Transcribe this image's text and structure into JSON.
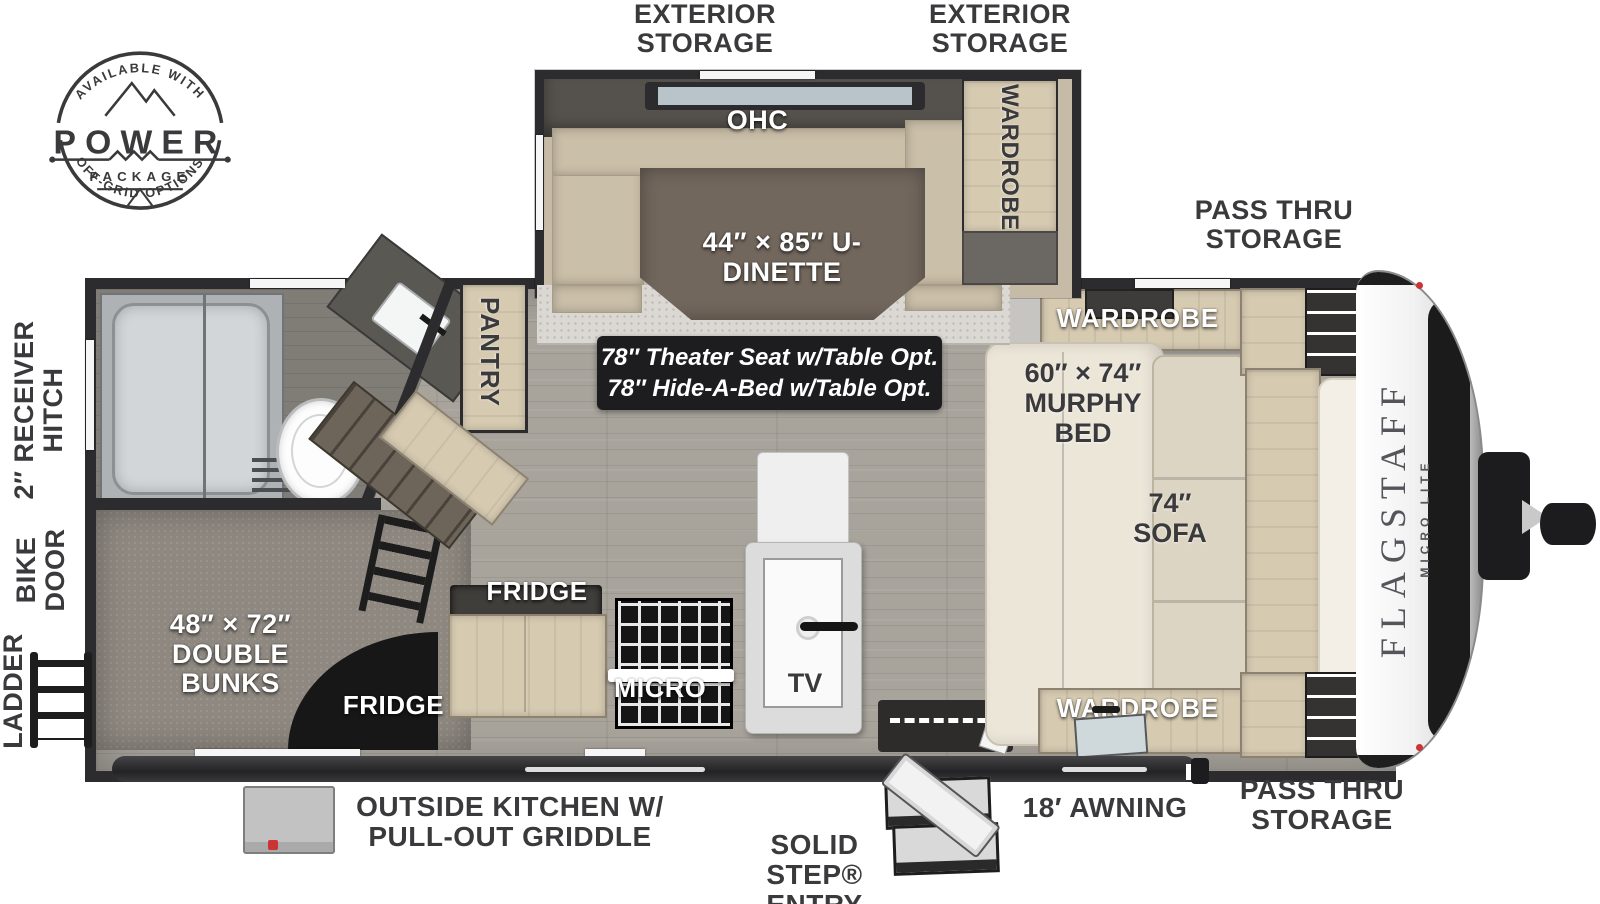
{
  "badge": {
    "arc_top": "AVAILABLE WITH",
    "word": "POWER",
    "word_sub": "PACKAGE",
    "arc_bottom": "OFF-GRID OPTIONS"
  },
  "top_labels": {
    "exterior_storage_left": "EXTERIOR STORAGE",
    "exterior_storage_right": "EXTERIOR STORAGE",
    "pass_thru_storage": "PASS THRU STORAGE"
  },
  "left_labels": {
    "receiver_hitch": "2″ RECEIVER HITCH",
    "bike_door": "BIKE DOOR",
    "ladder": "LADDER"
  },
  "bottom_labels": {
    "outside_kitchen": "OUTSIDE KITCHEN W/ PULL-OUT GRIDDLE",
    "solid_step": "SOLID STEP® ENTRY",
    "awning": "18′ AWNING",
    "pass_thru_storage": "PASS THRU STORAGE"
  },
  "slide": {
    "ohc": "OHC",
    "dinette": "44″ × 85″ U-DINETTE",
    "wardrobe": "WARDROBE"
  },
  "options_box": {
    "line1": "78″ Theater Seat w/Table Opt.",
    "line2": "78″ Hide-A-Bed w/Table Opt."
  },
  "rooms": {
    "pantry": "PANTRY",
    "double_bunks": "48″ × 72″ DOUBLE BUNKS",
    "fridge_top": "FRIDGE",
    "fridge_bottom": "FRIDGE",
    "micro": "MICRO",
    "tv": "TV",
    "murphy_bed": "60″ × 74″ MURPHY BED",
    "sofa": "74″ SOFA",
    "wardrobe_top": "WARDROBE",
    "wardrobe_bottom": "WARDROBE",
    "shelf": "SHELF"
  },
  "brand": {
    "name": "FLAGSTAFF",
    "series": "MICRO LITE"
  },
  "colors": {
    "label_dark": "#3a3a3c",
    "wall": "#2c2c2e",
    "wood_floor": "#a8a49c",
    "carpet": "#8e8880",
    "cabinet": "#d6cab1",
    "dinette_table": "#72675d",
    "options_bg": "#1d1d1f",
    "accent_red": "#cc3333"
  }
}
